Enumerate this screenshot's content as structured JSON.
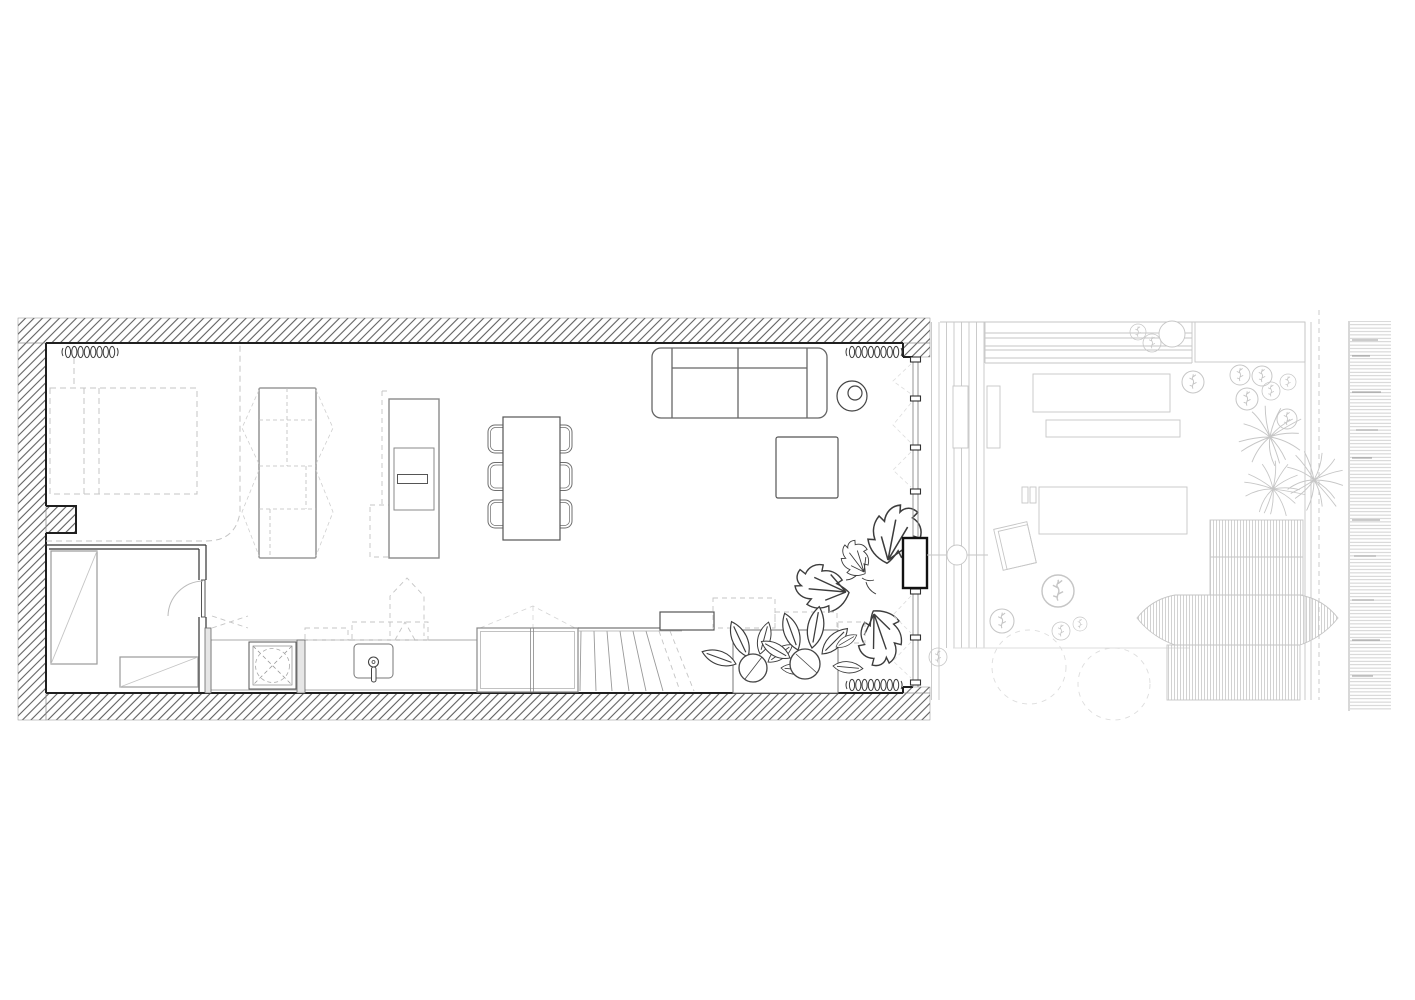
{
  "title": "Apartment floor plan with rear terrace",
  "drawing": {
    "kind": "architectural-plan",
    "colors": {
      "paper": "#ffffff",
      "wall_ink": "#1f1f1f",
      "hatch_ink": "#5f5f5f",
      "glass_ink": "#8a8a8a",
      "furn_ink": "#6e6e6e",
      "furn_dark": "#3c3c3c",
      "dash_light": "#c4c4c4",
      "terrace_ink": "#c6c6c6",
      "terrace_faint": "#dddddd",
      "plant_ink": "#3c3c3c",
      "panel_fill": "#e6e6e6"
    },
    "rooms": [
      {
        "name": "bedroom-alcove"
      },
      {
        "name": "bathroom"
      },
      {
        "name": "living-kitchen-dining"
      },
      {
        "name": "terrace"
      },
      {
        "name": "garden-strip"
      }
    ],
    "symbols": [
      "wall-hatch",
      "radiator",
      "bed-dashed",
      "wardrobe",
      "kitchen-island",
      "sink",
      "cooktop",
      "dining-table",
      "chair",
      "sofa",
      "round-side-table",
      "coffee-table",
      "monstera-plant",
      "potted-plant",
      "planter-box",
      "glass-balustrade",
      "winder-stairs",
      "pivot-door",
      "interior-door-swing",
      "glazed-facade",
      "deck-boards",
      "bench",
      "terrace-table",
      "sun-lounger",
      "shrub",
      "tree-canopy-dashed",
      "ornamental-grass",
      "slatted-canopy",
      "hedge-fence",
      "floor-light"
    ]
  }
}
